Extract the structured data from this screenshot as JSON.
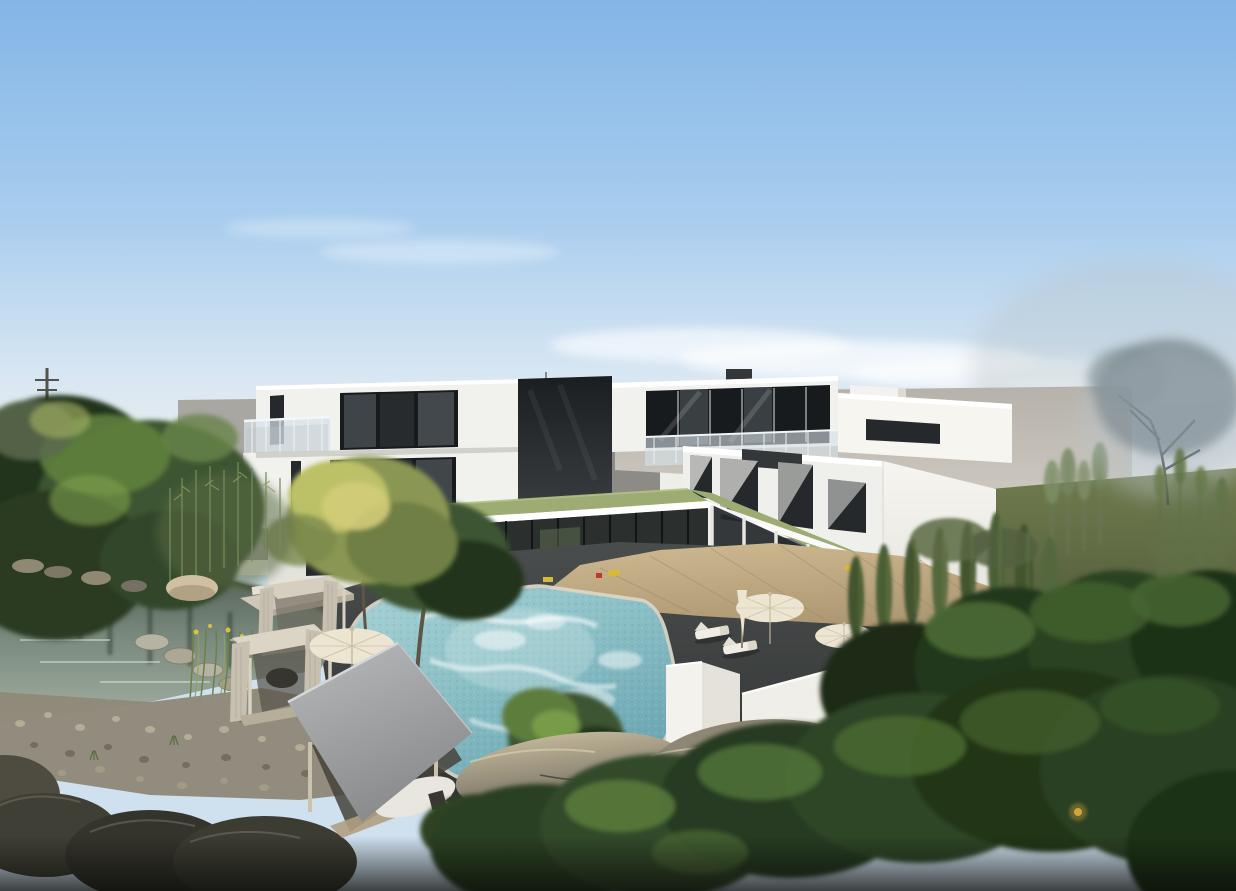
{
  "meta": {
    "title": "Architectural rendering of a modern residential complex",
    "alt": "Daytime 3D architectural visualization: white flat-roofed residential complex with an L-shaped olive-green glass corridor canopy, freeform turquoise courtyard pool with wooden deck, sun loungers and cream parasols, canopy daybeds with red and yellow cushions, a gray pavilion, a reflective pond with rocks, reeds and pebble shore on the left, bamboo and dense trees along a white perimeter wall, gray background walls, lawn and a misty tree under a hazy blue sky."
  },
  "scene": {
    "sky": {
      "description": "clear blue sky fading to a pale warm horizon, thin cloud wisps, mist at right"
    },
    "background": {
      "left": "gray box building with rooftop antenna and utility pole",
      "right": "long gray wall, olive lawn, slender trees, large misty tree"
    },
    "building": {
      "style": "modern white flat-roof volumes with dark glazing and glass balustrades",
      "left_wing": {
        "floors": 3,
        "features": [
          "roof terrace with glass railing",
          "stacked offset volumes",
          "dark recessed core"
        ]
      },
      "penthouse": {
        "features": [
          "full-width glazing",
          "rooftop boxes",
          "terrace glass balustrade"
        ]
      },
      "right_wing": {
        "floors": 2,
        "features": [
          "angled white window reveals",
          "bright blank side facade"
        ]
      },
      "canopy": {
        "shape": "L-shaped",
        "roof": "olive green with white fascia",
        "below": "glass corridor with white columns"
      }
    },
    "courtyard": {
      "pool": "freeform turquoise pool, stone coping, foam ripples",
      "deck": "diagonal wooden deck with plank joints",
      "furniture": [
        "sun loungers",
        "open cream parasols",
        "closed parasol"
      ],
      "accents": [
        "yellow and red poolside cushions"
      ],
      "trees": 2
    },
    "left_garden": {
      "pond": "dark reflective pond with sky streaks",
      "features": [
        "rocky bank",
        "beige boulder",
        "stepping stones",
        "reeds with yellow buds",
        "pebble beach",
        "dark boulders",
        "bamboo grove",
        "yellow-green tree",
        "two canopy daybeds",
        "outdoor sofa with red and yellow cushions",
        "cream parasol",
        "gray pavilion with white sofa and chair"
      ]
    },
    "right_garden": {
      "features": [
        "white perimeter wall with gate pillars",
        "bamboo hedge",
        "tall bamboo",
        "dense foreground trees",
        "warm garden light"
      ]
    }
  },
  "colors": {
    "sky_top": "#83b5e6",
    "sky_mid": "#a9cdee",
    "sky_soft": "#d9e7f3",
    "sky_horizon": "#f3f0e6",
    "cloud": "#ffffff",
    "mist": "#b9c4cb",
    "bg_building_light": "#a9a7a2",
    "bg_building_dark": "#8d8b86",
    "gray_wall_top": "#b6b2ab",
    "gray_wall_bottom": "#cdc9c0",
    "lawn_top": "#707c4e",
    "lawn_bottom": "#454e33",
    "building_white": "#f1f1ee",
    "building_side": "#f6f5f0",
    "building_shadow": "#d7d7d1",
    "fascia": "#ffffff",
    "core_dark": "#1b1e20",
    "window_dark": "#25292c",
    "window_pane": "#454c50",
    "window_frame": "#181b1d",
    "glass_railing": "#d5e1e7",
    "railing_post": "#eef2f3",
    "green_roof": "#9dac72",
    "green_roof_light": "#b3c187",
    "corridor_glass": "#2b302f",
    "column_white": "#e6e5df",
    "paving_top": "#4a4d4d",
    "paving_bottom": "#2e3130",
    "deck_top": "#cfba92",
    "deck_bottom": "#ab9671",
    "deck_line": "#9c8864",
    "pool_coping": "#d9d5c6",
    "pool_light": "#a8d2d6",
    "pool_mid": "#8ec2c8",
    "pool_deep": "#6ba5b2",
    "pool_foam": "#ffffff",
    "pond_top": "#47524a",
    "pond_mid": "#79897d",
    "pond_bottom": "#a3b0a2",
    "pond_reflection": "#2e382e",
    "rock_light": "#bfb498",
    "rock_dark": "#6b665a",
    "pebble": "#8f897a",
    "boulder_dark": "#3b3a32",
    "tree_dark": "#22351b",
    "tree_mid": "#3c5530",
    "tree_light": "#5d7d3c",
    "tree_highlight": "#7da04b",
    "tree_yellow": "#bcc168",
    "bamboo": "#5d7045",
    "trunk": "#5f5546",
    "foliage_dark": "#1c2b15",
    "umbrella": "#ece5d2",
    "umbrella_rib": "#c8bca0",
    "pole_gray": "#8a8577",
    "cabana_frame": "#d6cfc0",
    "cabana_curtain": "#c7c0b0",
    "cushion_red": "#c03a28",
    "cushion_yellow": "#d8b93c",
    "gazebo_light": "#b8babb",
    "gazebo_dark": "#898b8d",
    "utility_pole": "#53544d",
    "lamp_warm": "#d8a83e"
  }
}
